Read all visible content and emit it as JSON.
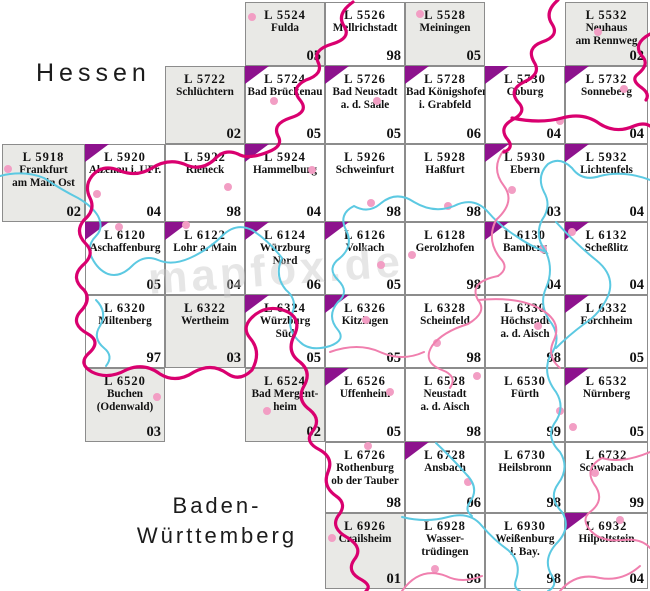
{
  "page": {
    "width": 650,
    "height": 591,
    "background": "#ffffff"
  },
  "regions": {
    "hessen": {
      "label": "Hessen"
    },
    "baden_wuerttemberg": {
      "line1": "Baden-",
      "line2": "Württemberg"
    }
  },
  "watermark": {
    "text": "mapfox.de"
  },
  "colors": {
    "cell-inside": "#ffffff",
    "cell-outside": "#e9e9e6",
    "cell-border": "#8c8c8c",
    "triangle": "#8d128d",
    "state-border": "#d9006f",
    "district-line": "#f07fae",
    "river": "#5cc9e2",
    "town-dot": "#f29ec4",
    "text": "#111111",
    "region-label": "#1c1c1c",
    "watermark": "#c9c9c9"
  },
  "grid": {
    "col_lefts": [
      2,
      85,
      165,
      245,
      325,
      405,
      485,
      565
    ],
    "col_widths": [
      83,
      80,
      80,
      80,
      80,
      80,
      80,
      83
    ],
    "row_tops": [
      2,
      66,
      144,
      222,
      295,
      368,
      442,
      513
    ],
    "row_heights": [
      64,
      78,
      78,
      73,
      73,
      74,
      71,
      76
    ]
  },
  "cells": [
    {
      "id": "L 5524",
      "name_lines": [
        "Fulda"
      ],
      "edition": "05",
      "col": 4,
      "row": 1,
      "outside": true,
      "triangle": false
    },
    {
      "id": "L 5526",
      "name_lines": [
        "Mellrichstadt"
      ],
      "edition": "98",
      "col": 5,
      "row": 1,
      "outside": false,
      "triangle": false
    },
    {
      "id": "L 5528",
      "name_lines": [
        "Meiningen"
      ],
      "edition": "05",
      "col": 6,
      "row": 1,
      "outside": true,
      "triangle": false
    },
    {
      "id": "L 5532",
      "name_lines": [
        "Neuhaus",
        "am Rennweg"
      ],
      "edition": "02",
      "col": 8,
      "row": 1,
      "outside": true,
      "triangle": false
    },
    {
      "id": "L 5722",
      "name_lines": [
        "Schlüchtern"
      ],
      "edition": "02",
      "col": 3,
      "row": 2,
      "outside": true,
      "triangle": false
    },
    {
      "id": "L 5724",
      "name_lines": [
        "Bad Brückenau"
      ],
      "edition": "05",
      "col": 4,
      "row": 2,
      "outside": false,
      "triangle": true
    },
    {
      "id": "L 5726",
      "name_lines": [
        "Bad Neustadt",
        "a. d. Saale"
      ],
      "edition": "05",
      "col": 5,
      "row": 2,
      "outside": false,
      "triangle": true
    },
    {
      "id": "L 5728",
      "name_lines": [
        "Bad Königshofen",
        "i. Grabfeld"
      ],
      "edition": "06",
      "col": 6,
      "row": 2,
      "outside": false,
      "triangle": true
    },
    {
      "id": "L 5730",
      "name_lines": [
        "Coburg"
      ],
      "edition": "04",
      "col": 7,
      "row": 2,
      "outside": false,
      "triangle": true
    },
    {
      "id": "L 5732",
      "name_lines": [
        "Sonneberg"
      ],
      "edition": "04",
      "col": 8,
      "row": 2,
      "outside": false,
      "triangle": true
    },
    {
      "id": "L 5918",
      "name_lines": [
        "Frankfurt",
        "am Main Ost"
      ],
      "edition": "02",
      "col": 1,
      "row": 3,
      "outside": true,
      "triangle": false
    },
    {
      "id": "L 5920",
      "name_lines": [
        "Alzenau i. UFr."
      ],
      "edition": "04",
      "col": 2,
      "row": 3,
      "outside": false,
      "triangle": true
    },
    {
      "id": "L 5922",
      "name_lines": [
        "Rieneck"
      ],
      "edition": "98",
      "col": 3,
      "row": 3,
      "outside": false,
      "triangle": false
    },
    {
      "id": "L 5924",
      "name_lines": [
        "Hammelburg"
      ],
      "edition": "04",
      "col": 4,
      "row": 3,
      "outside": false,
      "triangle": true
    },
    {
      "id": "L 5926",
      "name_lines": [
        "Schweinfurt"
      ],
      "edition": "98",
      "col": 5,
      "row": 3,
      "outside": false,
      "triangle": false
    },
    {
      "id": "L 5928",
      "name_lines": [
        "Haßfurt"
      ],
      "edition": "98",
      "col": 6,
      "row": 3,
      "outside": false,
      "triangle": false
    },
    {
      "id": "L 5930",
      "name_lines": [
        "Ebern"
      ],
      "edition": "03",
      "col": 7,
      "row": 3,
      "outside": false,
      "triangle": true
    },
    {
      "id": "L 5932",
      "name_lines": [
        "Lichtenfels"
      ],
      "edition": "04",
      "col": 8,
      "row": 3,
      "outside": false,
      "triangle": true
    },
    {
      "id": "L 6120",
      "name_lines": [
        "Aschaffenburg"
      ],
      "edition": "05",
      "col": 2,
      "row": 4,
      "outside": false,
      "triangle": true
    },
    {
      "id": "L 6122",
      "name_lines": [
        "Lohr a. Main"
      ],
      "edition": "04",
      "col": 3,
      "row": 4,
      "outside": false,
      "triangle": true
    },
    {
      "id": "L 6124",
      "name_lines": [
        "Würzburg",
        "Nord"
      ],
      "edition": "06",
      "col": 4,
      "row": 4,
      "outside": false,
      "triangle": true
    },
    {
      "id": "L 6126",
      "name_lines": [
        "Volkach"
      ],
      "edition": "05",
      "col": 5,
      "row": 4,
      "outside": false,
      "triangle": true
    },
    {
      "id": "L 6128",
      "name_lines": [
        "Gerolzhofen"
      ],
      "edition": "98",
      "col": 6,
      "row": 4,
      "outside": false,
      "triangle": false
    },
    {
      "id": "L 6130",
      "name_lines": [
        "Bamberg"
      ],
      "edition": "04",
      "col": 7,
      "row": 4,
      "outside": false,
      "triangle": true
    },
    {
      "id": "L 6132",
      "name_lines": [
        "Scheßlitz"
      ],
      "edition": "04",
      "col": 8,
      "row": 4,
      "outside": false,
      "triangle": true
    },
    {
      "id": "L 6320",
      "name_lines": [
        "Miltenberg"
      ],
      "edition": "97",
      "col": 2,
      "row": 5,
      "outside": false,
      "triangle": false
    },
    {
      "id": "L 6322",
      "name_lines": [
        "Wertheim"
      ],
      "edition": "03",
      "col": 3,
      "row": 5,
      "outside": true,
      "triangle": false
    },
    {
      "id": "L 6324",
      "name_lines": [
        "Würzburg",
        "Süd"
      ],
      "edition": "05",
      "col": 4,
      "row": 5,
      "outside": false,
      "triangle": true
    },
    {
      "id": "L 6326",
      "name_lines": [
        "Kitzingen"
      ],
      "edition": "05",
      "col": 5,
      "row": 5,
      "outside": false,
      "triangle": true
    },
    {
      "id": "L 6328",
      "name_lines": [
        "Scheinfeld"
      ],
      "edition": "98",
      "col": 6,
      "row": 5,
      "outside": false,
      "triangle": false
    },
    {
      "id": "L 6330",
      "name_lines": [
        "Höchstadt",
        "a. d. Aisch"
      ],
      "edition": "98",
      "col": 7,
      "row": 5,
      "outside": false,
      "triangle": false
    },
    {
      "id": "L 6332",
      "name_lines": [
        "Forchheim"
      ],
      "edition": "05",
      "col": 8,
      "row": 5,
      "outside": false,
      "triangle": true
    },
    {
      "id": "L 6520",
      "name_lines": [
        "Buchen",
        "(Odenwald)"
      ],
      "edition": "03",
      "col": 2,
      "row": 6,
      "outside": true,
      "triangle": false
    },
    {
      "id": "L 6524",
      "name_lines": [
        "Bad Mergent-",
        "heim"
      ],
      "edition": "02",
      "col": 4,
      "row": 6,
      "outside": true,
      "triangle": false
    },
    {
      "id": "L 6526",
      "name_lines": [
        "Uffenheim"
      ],
      "edition": "05",
      "col": 5,
      "row": 6,
      "outside": false,
      "triangle": true
    },
    {
      "id": "L 6528",
      "name_lines": [
        "Neustadt",
        "a. d. Aisch"
      ],
      "edition": "98",
      "col": 6,
      "row": 6,
      "outside": false,
      "triangle": false
    },
    {
      "id": "L 6530",
      "name_lines": [
        "Fürth"
      ],
      "edition": "99",
      "col": 7,
      "row": 6,
      "outside": false,
      "triangle": false
    },
    {
      "id": "L 6532",
      "name_lines": [
        "Nürnberg"
      ],
      "edition": "05",
      "col": 8,
      "row": 6,
      "outside": false,
      "triangle": true
    },
    {
      "id": "L 6726",
      "name_lines": [
        "Rothenburg",
        "ob der Tauber"
      ],
      "edition": "98",
      "col": 5,
      "row": 7,
      "outside": false,
      "triangle": false
    },
    {
      "id": "L 6728",
      "name_lines": [
        "Ansbach"
      ],
      "edition": "06",
      "col": 6,
      "row": 7,
      "outside": false,
      "triangle": true
    },
    {
      "id": "L 6730",
      "name_lines": [
        "Heilsbronn"
      ],
      "edition": "98",
      "col": 7,
      "row": 7,
      "outside": false,
      "triangle": false
    },
    {
      "id": "L 6732",
      "name_lines": [
        "Schwabach"
      ],
      "edition": "99",
      "col": 8,
      "row": 7,
      "outside": false,
      "triangle": false
    },
    {
      "id": "L 6926",
      "name_lines": [
        "Crailsheim"
      ],
      "edition": "01",
      "col": 5,
      "row": 8,
      "outside": true,
      "triangle": false
    },
    {
      "id": "L 6928",
      "name_lines": [
        "Wasser-",
        "trüdingen"
      ],
      "edition": "98",
      "col": 6,
      "row": 8,
      "outside": false,
      "triangle": false
    },
    {
      "id": "L 6930",
      "name_lines": [
        "Weißenburg",
        "i. Bay."
      ],
      "edition": "98",
      "col": 7,
      "row": 8,
      "outside": false,
      "triangle": false
    },
    {
      "id": "L 6932",
      "name_lines": [
        "Hilpoltstein"
      ],
      "edition": "04",
      "col": 8,
      "row": 8,
      "outside": false,
      "triangle": true
    }
  ],
  "dots": [
    [
      252,
      17
    ],
    [
      420,
      14
    ],
    [
      598,
      32
    ],
    [
      274,
      101
    ],
    [
      377,
      101
    ],
    [
      560,
      121
    ],
    [
      624,
      89
    ],
    [
      8,
      169
    ],
    [
      97,
      194
    ],
    [
      228,
      187
    ],
    [
      312,
      170
    ],
    [
      371,
      203
    ],
    [
      448,
      206
    ],
    [
      512,
      190
    ],
    [
      119,
      227
    ],
    [
      186,
      225
    ],
    [
      381,
      265
    ],
    [
      412,
      255
    ],
    [
      543,
      249
    ],
    [
      572,
      232
    ],
    [
      366,
      320
    ],
    [
      437,
      343
    ],
    [
      538,
      326
    ],
    [
      157,
      397
    ],
    [
      267,
      411
    ],
    [
      390,
      392
    ],
    [
      477,
      376
    ],
    [
      560,
      411
    ],
    [
      573,
      427
    ],
    [
      368,
      446
    ],
    [
      468,
      482
    ],
    [
      595,
      473
    ],
    [
      332,
      538
    ],
    [
      435,
      569
    ],
    [
      620,
      520
    ]
  ]
}
